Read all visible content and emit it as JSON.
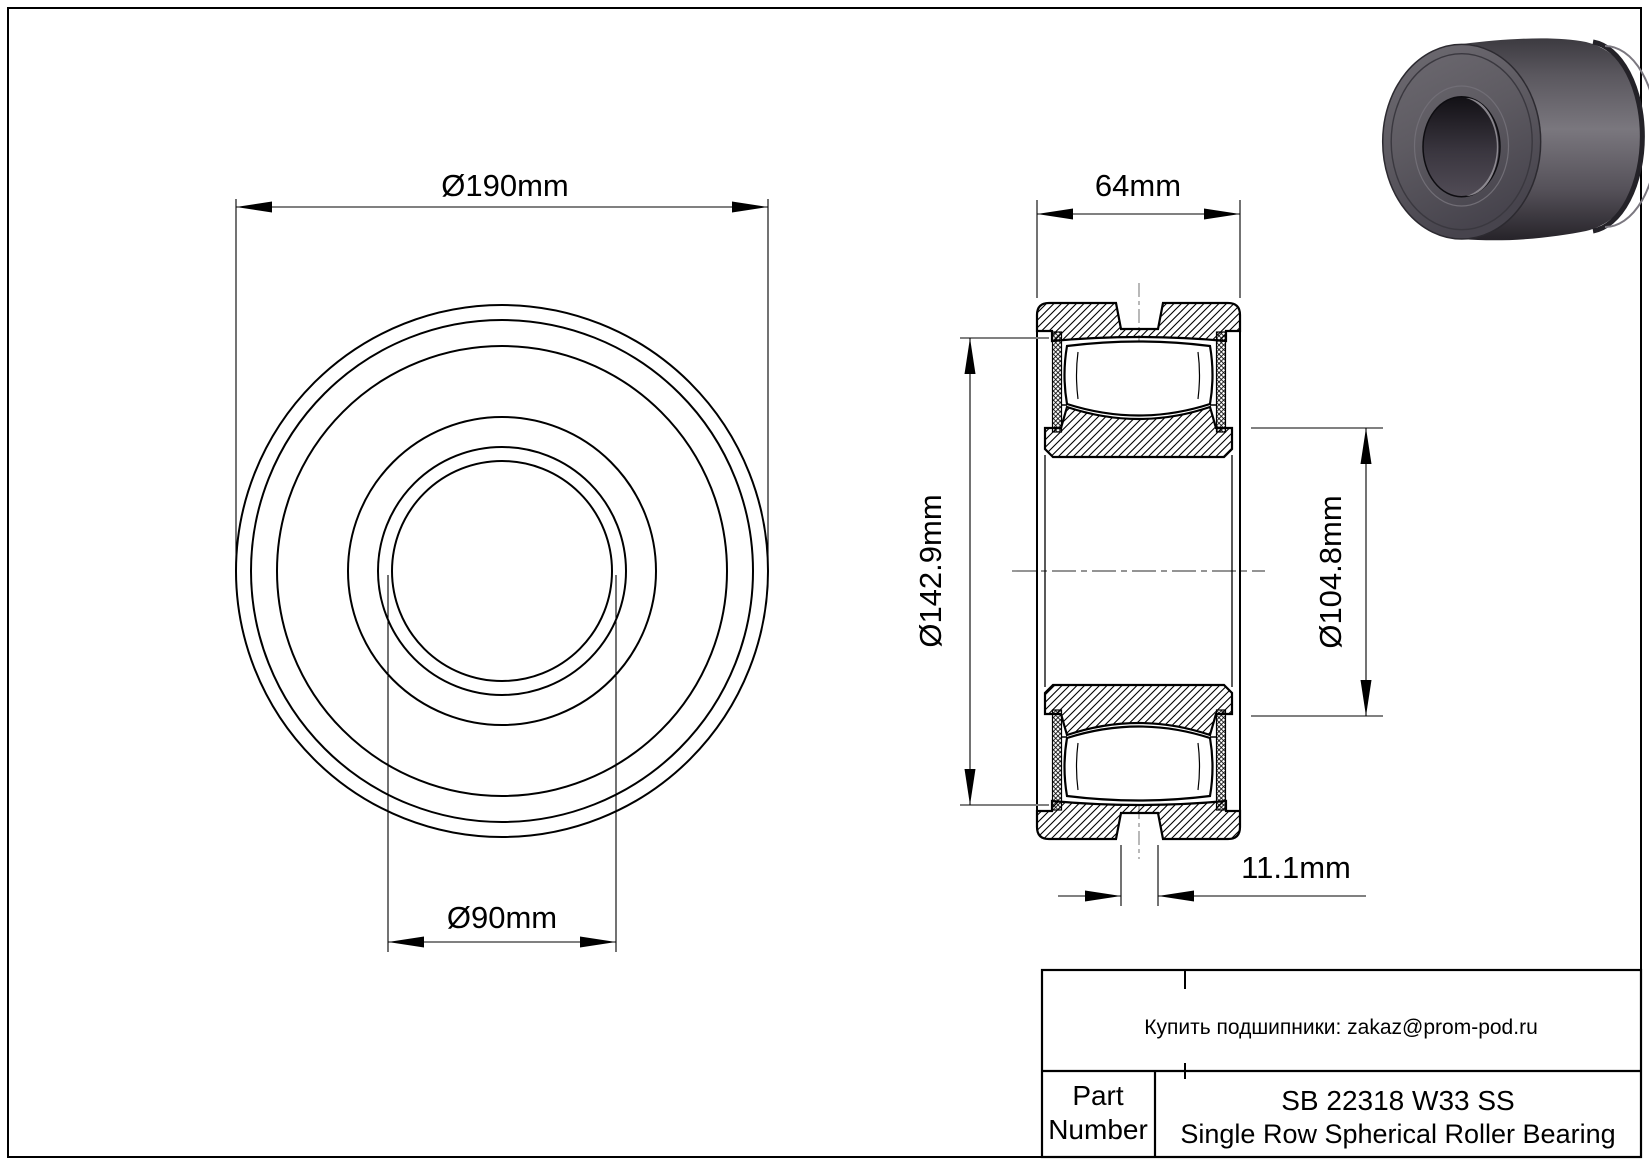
{
  "drawing_type": "bearing engineering drawing",
  "front_view": {
    "dim_outer_diameter": "Ø190mm",
    "dim_bore_diameter": "Ø90mm"
  },
  "section_view": {
    "dim_width": "64mm",
    "dim_outer_raceway_diameter": "Ø142.9mm",
    "dim_inner_shoulder_diameter": "Ø104.8mm",
    "dim_groove_width": "11.1mm"
  },
  "title_block": {
    "contact_line": "Купить подшипники: zakaz@prom-pod.ru",
    "part_label_line1": "Part",
    "part_label_line2": "Number",
    "part_number": "SB 22318 W33 SS",
    "part_description": "Single Row Spherical Roller Bearing"
  },
  "colors": {
    "background": "#ffffff",
    "line": "#000000",
    "dim_tick_gray": "#808080",
    "centerline_gray": "#6e6e6e",
    "render_body_light": "#7a777e",
    "render_body_dark": "#2a282d",
    "render_face": "#5e5b62",
    "render_bore_dark": "#17151a",
    "render_bore_highlight": "#9a979d"
  }
}
